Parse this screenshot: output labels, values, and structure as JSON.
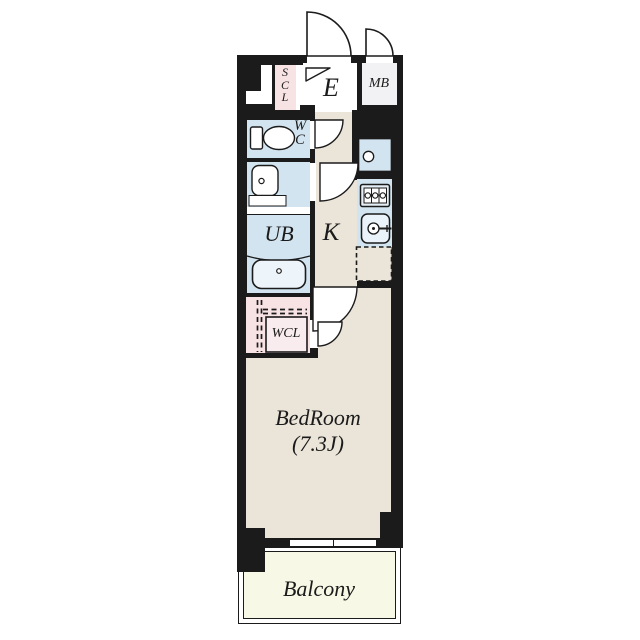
{
  "floor_plan": {
    "rooms": {
      "entrance": {
        "label": "E"
      },
      "meter_box": {
        "label": "MB"
      },
      "shoe_closet": {
        "label": "SCL",
        "letters": [
          "S",
          "C",
          "L"
        ]
      },
      "toilet": {
        "label": "WC",
        "letters": [
          "W",
          "C"
        ]
      },
      "unit_bath": {
        "label": "UB"
      },
      "kitchen": {
        "label": "K"
      },
      "walk_in_closet": {
        "label": "WCL"
      },
      "bedroom": {
        "label": "BedRoom",
        "size": "(7.3J)"
      },
      "balcony": {
        "label": "Balcony"
      }
    },
    "colors": {
      "wall": "#1b1b1b",
      "floor": "#ebe4d8",
      "wet_area": "#d2e4f0",
      "closet": "#f7e2e4",
      "balcony": "#f8f8e6",
      "meter_box": "#f2f2f4",
      "fixture": "#ffffff"
    }
  }
}
